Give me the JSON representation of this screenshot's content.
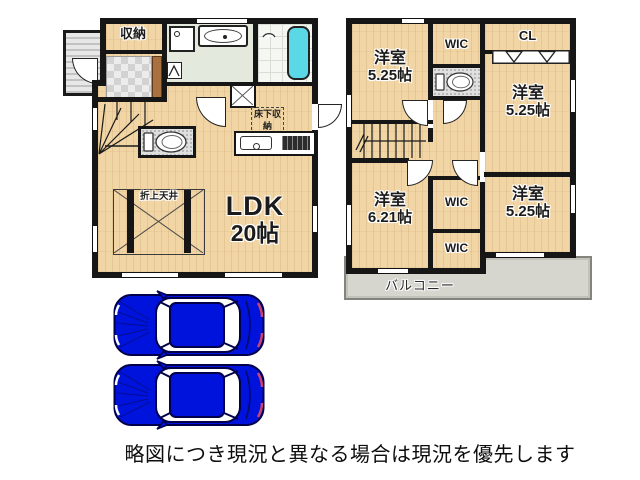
{
  "floor1": {
    "storage": "収納",
    "underfloor_storage": "床下収納",
    "raised_ceiling": "折上天井",
    "ldk": {
      "name": "LDK",
      "size": "20帖"
    }
  },
  "floor2": {
    "room_top_left": {
      "name": "洋室",
      "size": "5.25帖"
    },
    "room_top_right": {
      "name": "洋室",
      "size": "5.25帖"
    },
    "room_bottom_left": {
      "name": "洋室",
      "size": "6.21帖"
    },
    "room_bottom_right": {
      "name": "洋室",
      "size": "5.25帖"
    },
    "wic_top": "WIC",
    "wic_middle": "WIC",
    "wic_bottom": "WIC",
    "closet": "CL",
    "balcony": "バルコニー"
  },
  "footer": {
    "disclaimer": "略図につき現況と異なる場合は現況を優先します"
  },
  "colors": {
    "floor_wood": "#f1d5a5",
    "wall": "#161616",
    "bathtub": "#5bd8e6",
    "balcony_floor": "#d6d6cf",
    "entry_tile": "#d2d2d2",
    "car_body": "#0013dc",
    "disclaimer_text": "#0d0d0d"
  },
  "icons": {
    "bathtub-icon": "cyan rounded rect",
    "shower-icon": "small arc",
    "washbasin-icon": "oval in rect",
    "washing-machine-icon": "square with circle",
    "toilet-icon": "tank + bowl ellipse",
    "kitchen-sink-icon": "rounded rect with drain circle",
    "stove-icon": "dark grill rect",
    "stairs-icon": "tread lines with arrow",
    "door-arc-icon": "quarter circle swing",
    "closet-door-icon": "white band with two triangles",
    "raised-ceiling-icon": "box with X cross",
    "pantry-cross-icon": "square with X",
    "car-top-view-icon": "blue sedan seen from above"
  }
}
